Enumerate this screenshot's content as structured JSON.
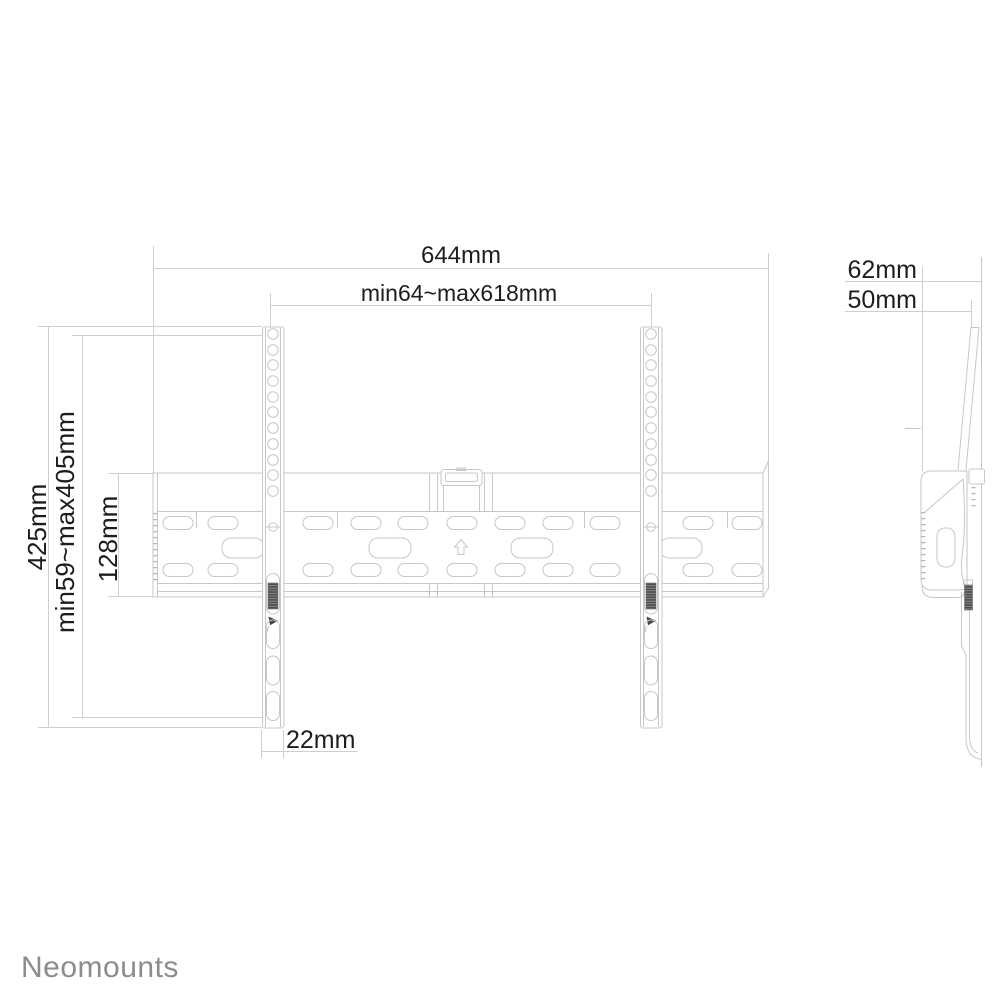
{
  "drawing": {
    "background": "#ffffff",
    "line_color": "#c7c7c7",
    "dim_line_color": "#cfcfcf",
    "detail_line_color": "#b5b5b5",
    "text_color": "#1d1d1d",
    "screw_color": "#474747",
    "logo_color": "#8c8c8c"
  },
  "front_view": {
    "dimensions": {
      "total_width": "644mm",
      "horizontal_adjust_range": "min64~max618mm",
      "total_height": "425mm",
      "vertical_adjust_range": "min59~max405mm",
      "wall_plate_height": "128mm",
      "rail_width": "22mm"
    }
  },
  "side_view": {
    "dimensions": {
      "depth_max": "62mm",
      "depth_min": "50mm"
    }
  },
  "icons": {
    "up_arrow": "⇧"
  },
  "brand": {
    "logo_text": "Neomounts"
  }
}
